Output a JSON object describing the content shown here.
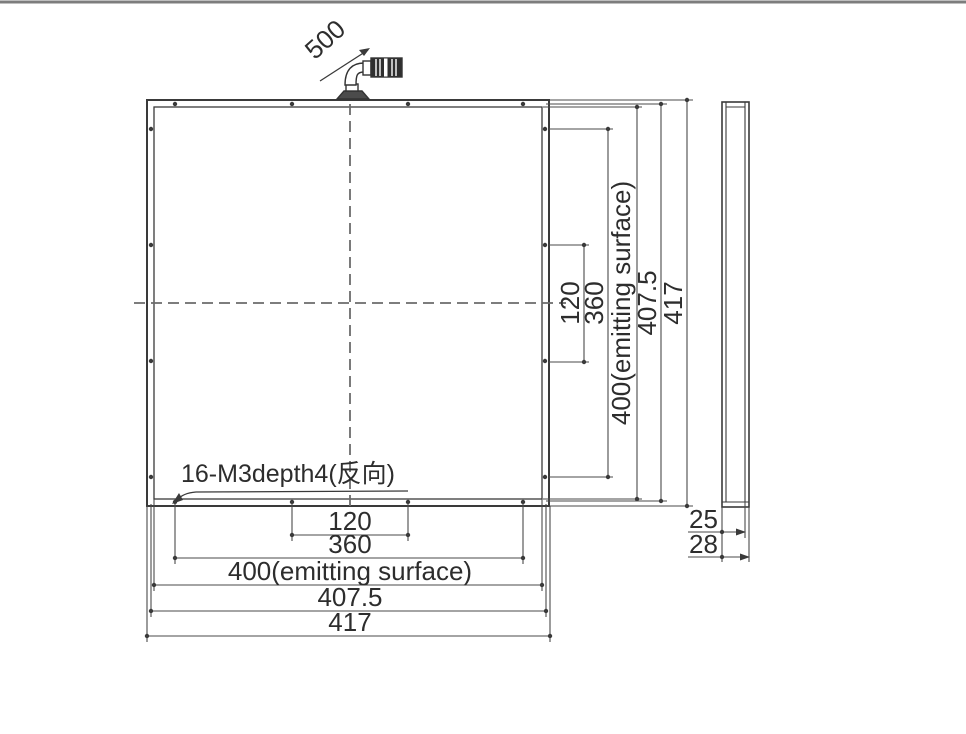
{
  "drawing": {
    "line_color": "#3a3a3a",
    "centerline_color": "#6b6b6b",
    "cable": {
      "length_label": "500"
    },
    "mounting_note": "16-M3depth4(反向)",
    "front_view": {
      "bottom_dims": [
        "120",
        "360",
        "400(emitting surface)",
        "407.5",
        "417"
      ],
      "right_dims": [
        "120",
        "360",
        "400(emitting surface)",
        "407.5",
        "417"
      ]
    },
    "side_view": {
      "thickness_dims": [
        "25",
        "28"
      ]
    }
  }
}
